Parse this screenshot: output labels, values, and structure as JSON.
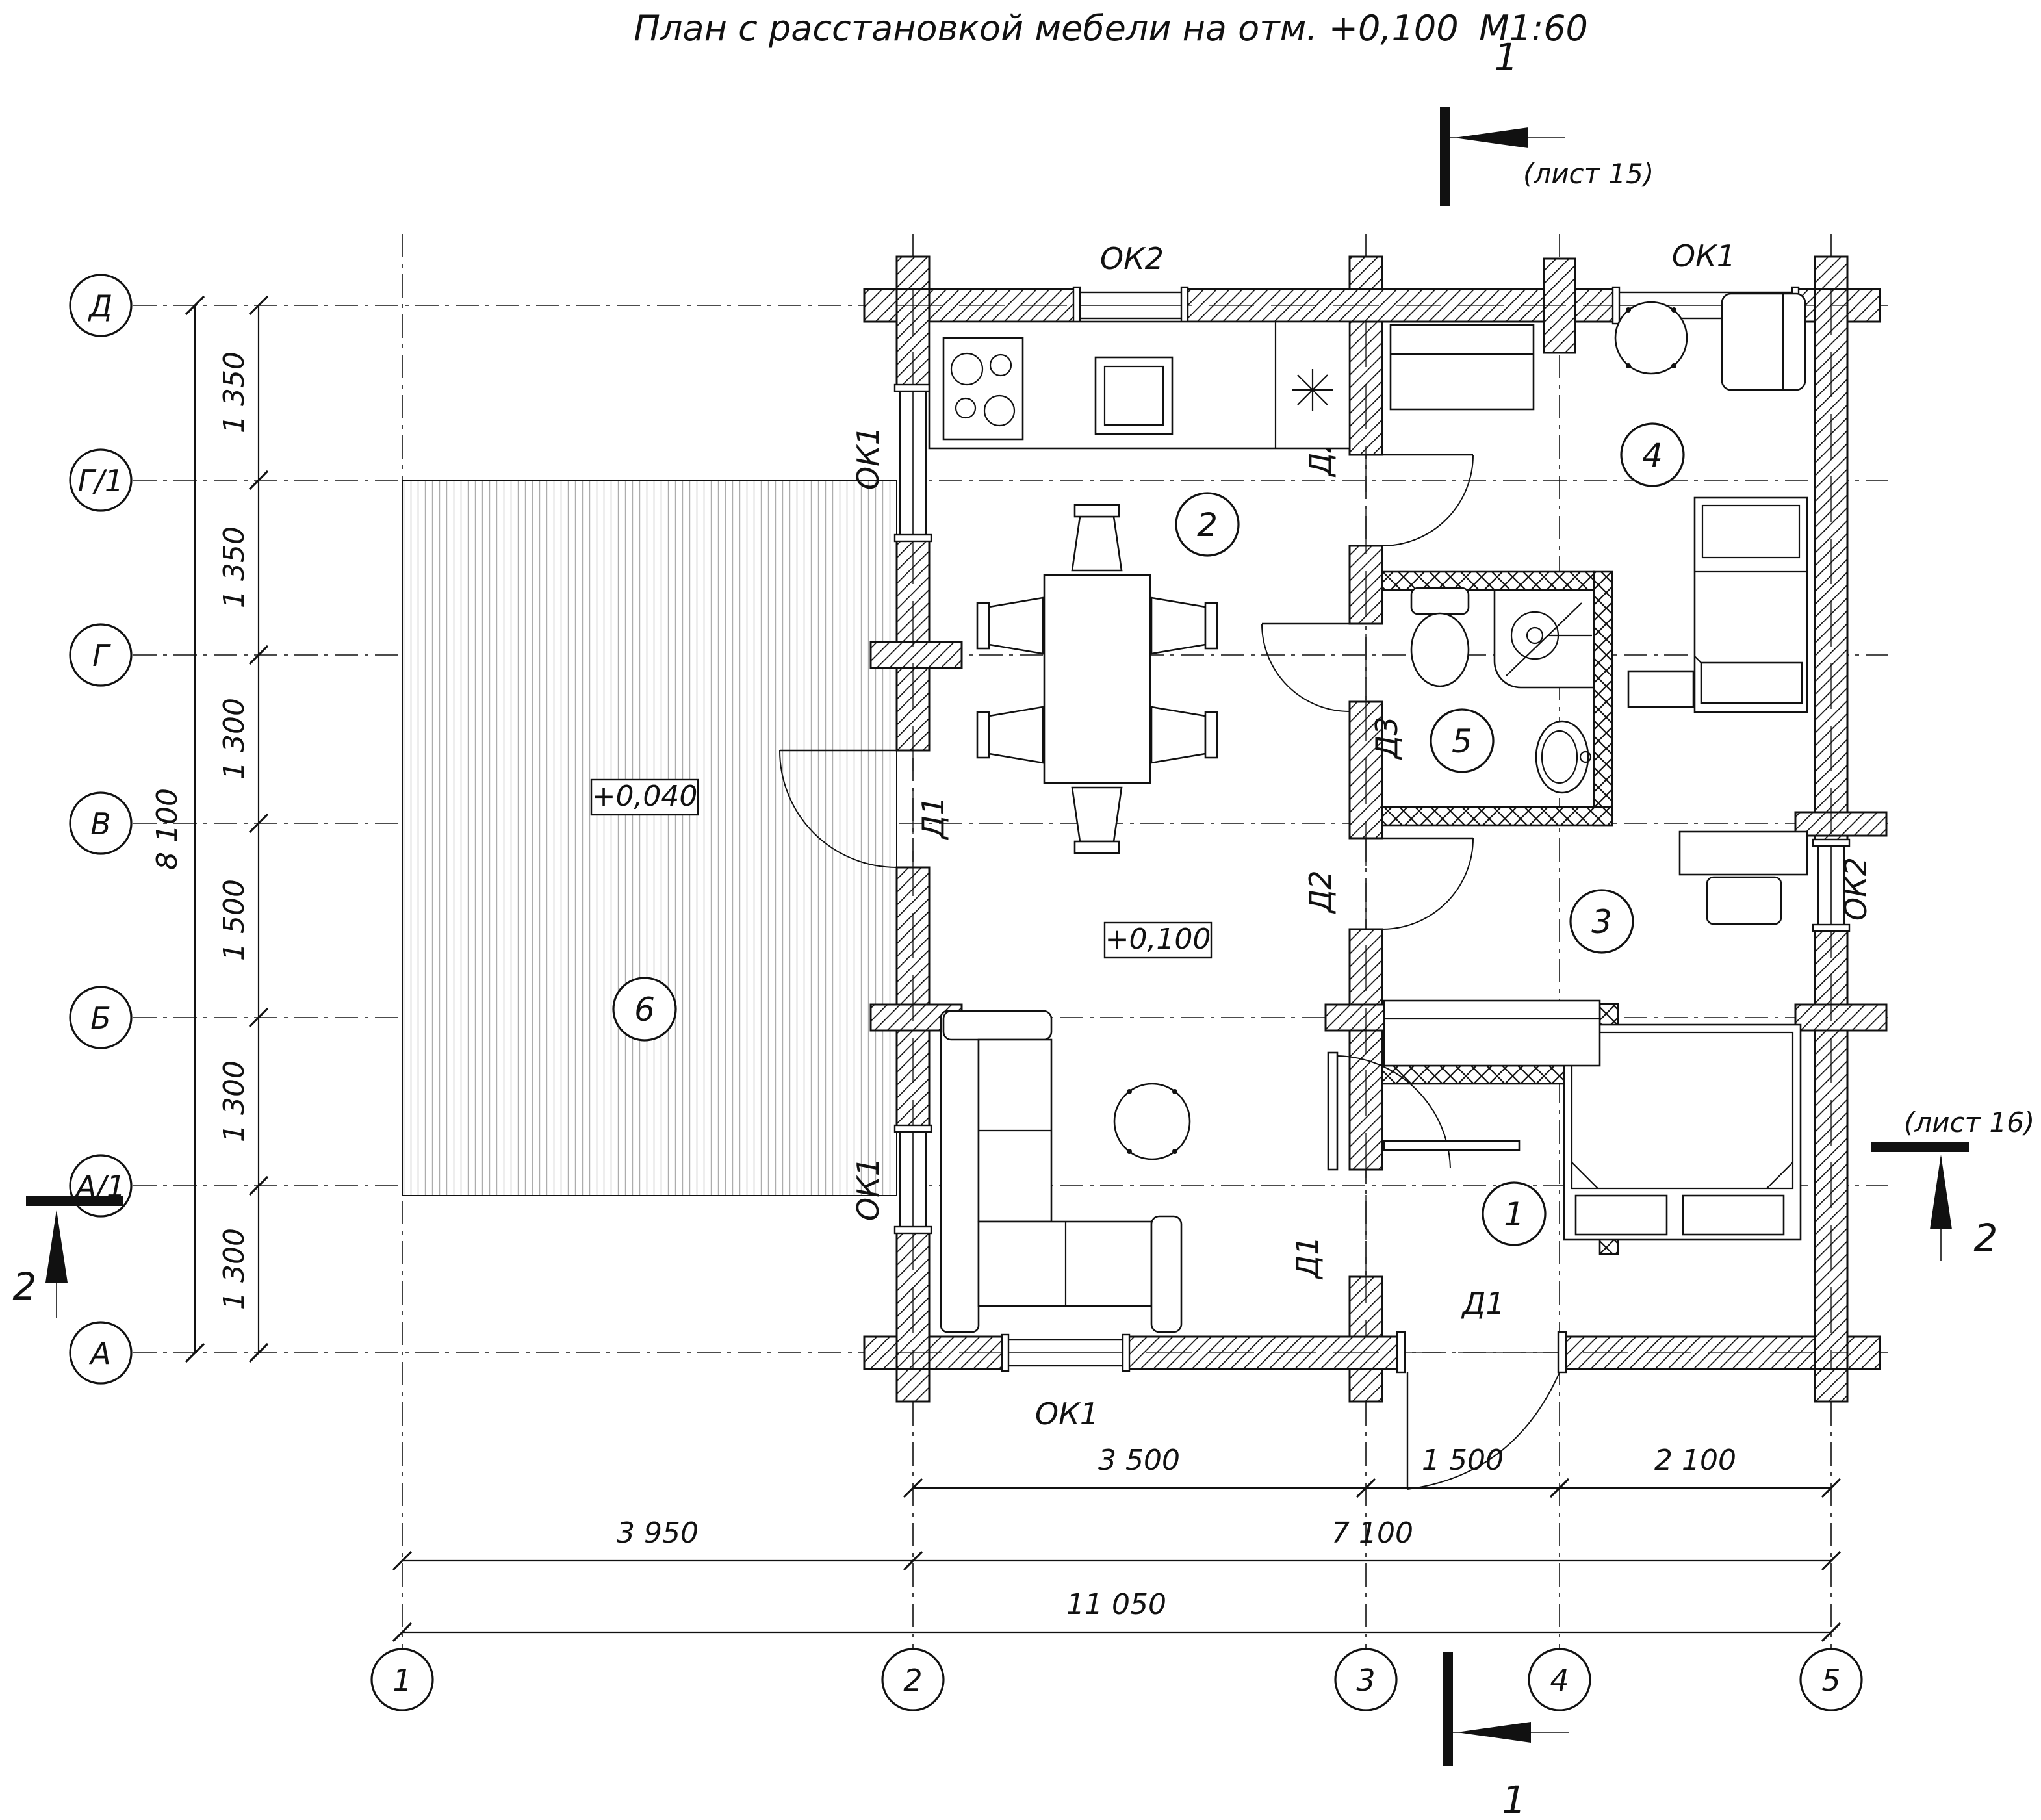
{
  "title": {
    "text": "План с расстановкой мебели на отм. +0,100",
    "scale_label": "М1:60"
  },
  "section_markers": {
    "top": {
      "number": "1",
      "sheet_ref": "(лист 15)"
    },
    "bottom": {
      "number": "1"
    },
    "left": {
      "number": "2"
    },
    "right": {
      "number": "2",
      "sheet_ref": "(лист 16)"
    }
  },
  "axes": {
    "rows": [
      {
        "label": "Д"
      },
      {
        "label": "Г/1"
      },
      {
        "label": "Г"
      },
      {
        "label": "В"
      },
      {
        "label": "Б"
      },
      {
        "label": "А/1"
      },
      {
        "label": "А"
      }
    ],
    "cols": [
      {
        "label": "1"
      },
      {
        "label": "2"
      },
      {
        "label": "3"
      },
      {
        "label": "4"
      },
      {
        "label": "5"
      }
    ]
  },
  "dimensions": {
    "left_segments": [
      "1 350",
      "1 350",
      "1 300",
      "1 500",
      "1 300",
      "1 300"
    ],
    "left_total": "8 100",
    "bottom_row1": [
      "3 500",
      "1 500",
      "2 100"
    ],
    "bottom_row2": [
      "3 950",
      "7 100"
    ],
    "bottom_total": "11 050"
  },
  "rooms": [
    {
      "number": "1"
    },
    {
      "number": "2"
    },
    {
      "number": "3"
    },
    {
      "number": "4"
    },
    {
      "number": "5"
    },
    {
      "number": "6"
    }
  ],
  "elevations": {
    "terrace": "+0,040",
    "floor": "+0,100"
  },
  "openings": {
    "windows": [
      {
        "id": "ok2-top",
        "label": "ОК2"
      },
      {
        "id": "ok1-top",
        "label": "ОК1"
      },
      {
        "id": "ok1-left-upper",
        "label": "ОК1"
      },
      {
        "id": "ok1-left-lower",
        "label": "ОК1"
      },
      {
        "id": "ok1-bottom",
        "label": "ОК1"
      },
      {
        "id": "ok2-right",
        "label": "ОК2"
      }
    ],
    "doors": [
      {
        "id": "d2-upper",
        "label": "Д2"
      },
      {
        "id": "d3-bath",
        "label": "Д3"
      },
      {
        "id": "d2-lower",
        "label": "Д2"
      },
      {
        "id": "d1-terrace",
        "label": "Д1"
      },
      {
        "id": "d1-hall",
        "label": "Д1"
      },
      {
        "id": "d1-entry",
        "label": "Д1"
      }
    ]
  },
  "colors": {
    "line": "#111111",
    "deck_line": "#adadad",
    "background": "#ffffff"
  }
}
